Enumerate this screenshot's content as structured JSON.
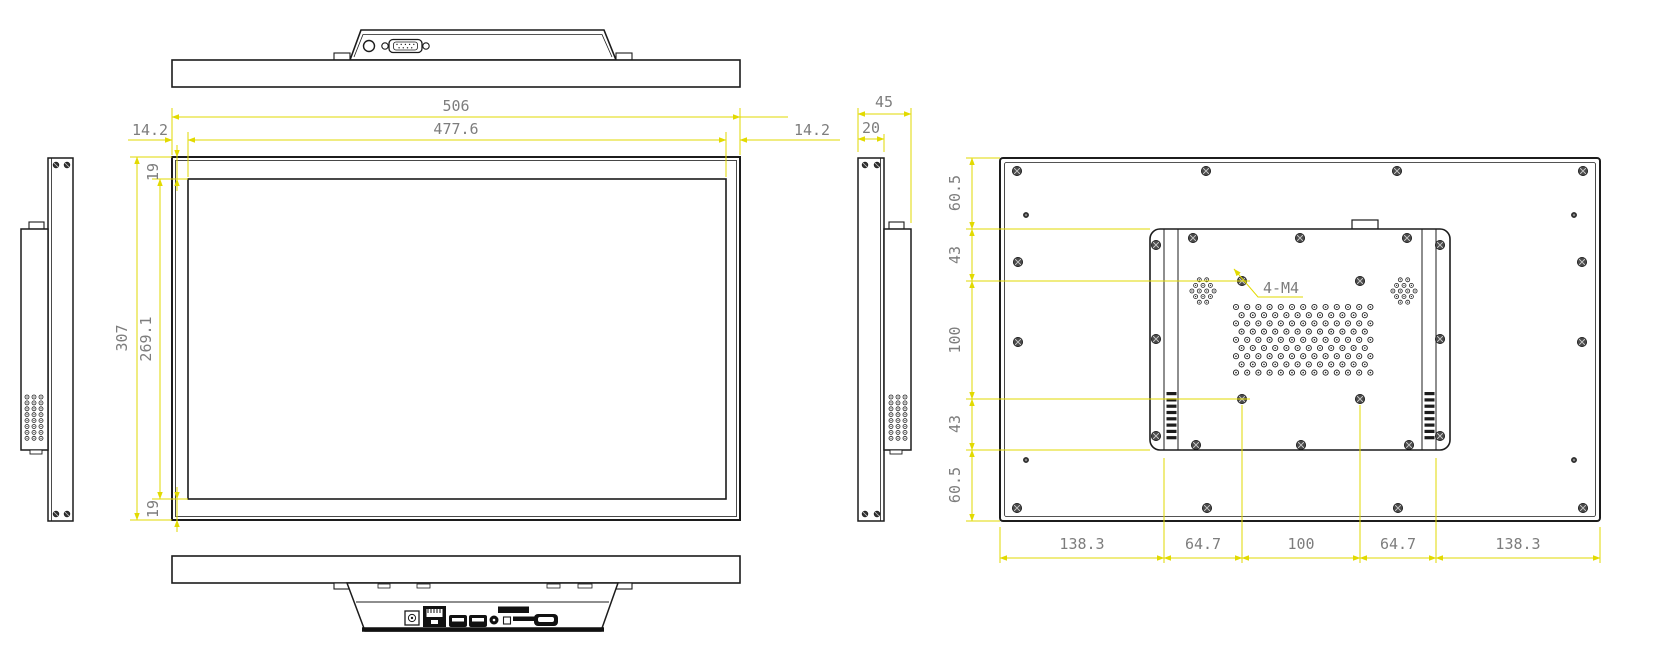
{
  "drawing_type": "monitor-technical-drawing",
  "colors": {
    "line": "#1c1c1c",
    "dimension_line": "#e2da00",
    "dimension_text": "#7d7d7d",
    "background": "#ffffff"
  },
  "dims": {
    "front_width_total": "506",
    "front_width_display": "477.6",
    "front_bezel_left": "14.2",
    "front_bezel_right": "14.2",
    "front_bezel_top": "19",
    "front_bezel_bottom": "19",
    "front_height_total": "307",
    "front_height_display": "269.1",
    "side_depth_total": "45",
    "side_depth_front": "20",
    "rear_left": [
      "60.5",
      "43",
      "100",
      "43",
      "60.5"
    ],
    "rear_bottom": [
      "138.3",
      "64.7",
      "100",
      "64.7",
      "138.3"
    ]
  },
  "annotations": {
    "vesa_holes": "4-M4"
  },
  "icons": [
    "power-button",
    "serial-port-db9",
    "dc-power-jack",
    "ethernet-port",
    "usb-port",
    "usb-port",
    "audio-jack",
    "led-indicator",
    "sim-card-slot",
    "sd-card-slot",
    "hdmi-port",
    "speaker-grille",
    "vent-holes",
    "vent-slots",
    "vesa-screw",
    "case-screw"
  ]
}
